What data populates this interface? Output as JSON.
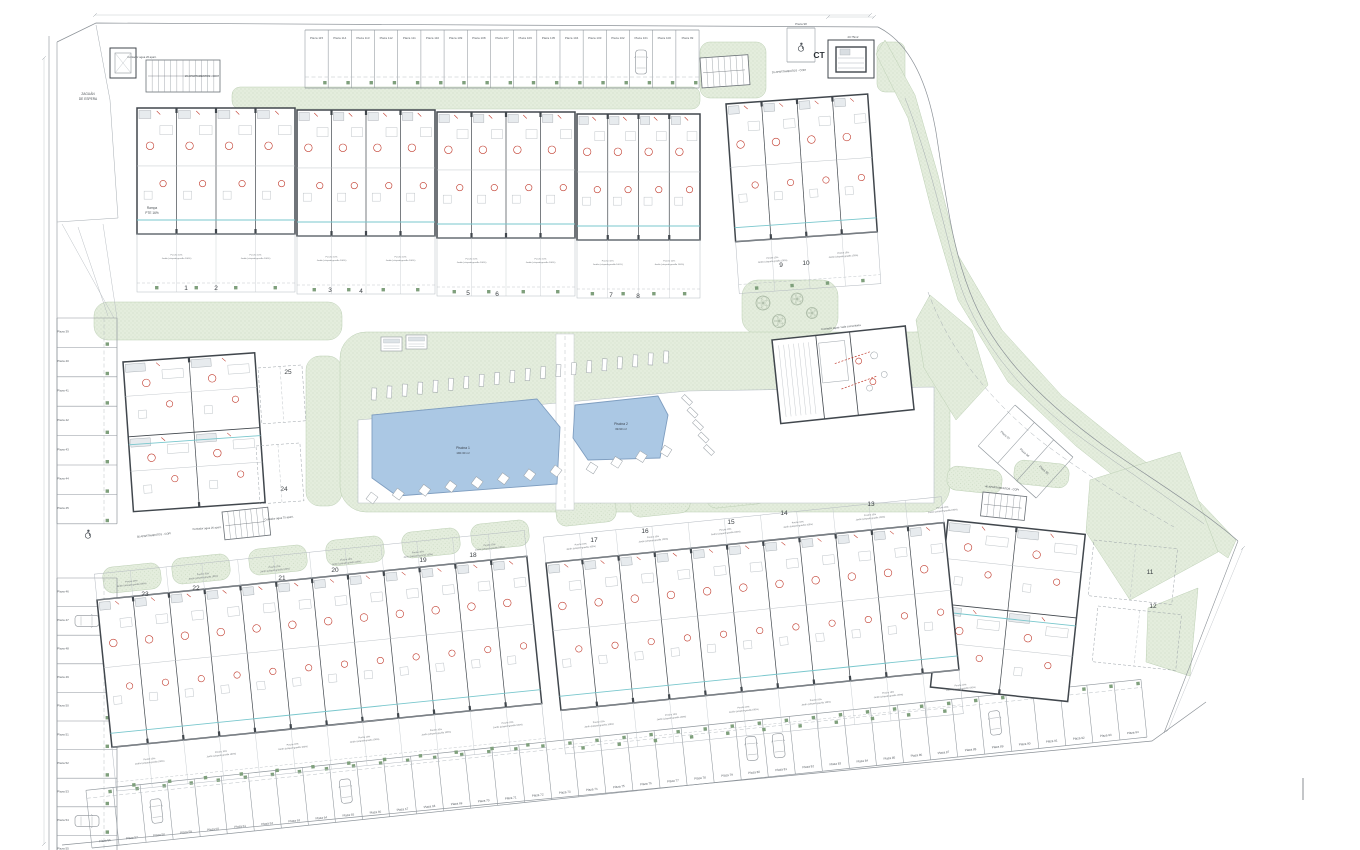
{
  "colors": {
    "paper": "#ffffff",
    "line": "#9aa1a7",
    "wall": "#41474d",
    "light": "#c0c5ca",
    "green_fill": "#e4eddd",
    "green_dot": "#c2d3b9",
    "green_stroke": "#bccfb4",
    "green_square": "#7fa07c",
    "pool_fill": "#abc8e4",
    "pool_stroke": "#7f9ec0",
    "red": "#c0392b",
    "cyan": "#79c7cd",
    "text": "#4a5055"
  },
  "annotations": {
    "zaguan_line1": "ZAGUÁN",
    "zaguan_line2": "DE ESPERA",
    "rampa_line1": "Rampa",
    "rampa_line2": "PTE 16%",
    "contador_26": "Contador agua 26 apart.",
    "contador_75": "Contador agua 75 apart.",
    "contador_comunitaria": "Contador agua / sala comunitaria",
    "apartamentos_26": "26 APARTAMENTOS - COPI",
    "apartamentos_36": "36 APARTAMENTOS - COPI",
    "apartamentos_40": "40 APARTAMENTOS - COPI",
    "ct_label": "CT",
    "ct_area": "20.75m2"
  },
  "pools": [
    {
      "name": "Piscina 1",
      "area": "190.30 m²"
    },
    {
      "name": "Piscina 2",
      "area": "39.90 m²"
    }
  ],
  "blocks": {
    "top": [
      "1",
      "2",
      "3",
      "4",
      "5",
      "6",
      "7",
      "8"
    ],
    "top_right": [
      "9",
      "10"
    ],
    "right": [
      "11",
      "12"
    ],
    "bottom_middle": [
      "13",
      "14",
      "15",
      "16",
      "17"
    ],
    "bottom_left": [
      "18",
      "19",
      "20",
      "21",
      "22",
      "23"
    ],
    "middle_left": [
      "24",
      "25"
    ]
  },
  "parking": {
    "top_row": [
      "Plaza 115",
      "Plaza 114",
      "Plaza 113",
      "Plaza 112",
      "Plaza 111",
      "Plaza 110",
      "Plaza 109",
      "Plaza 108",
      "Plaza 107",
      "Plaza 106",
      "Plaza 105",
      "Plaza 104",
      "Plaza 103",
      "Plaza 102",
      "Plaza 101",
      "Plaza 100",
      "Plaza 99"
    ],
    "ct_stall": [
      "Plaza 98"
    ],
    "left_upper": [
      "Plaza 39",
      "Plaza 40",
      "Plaza 41",
      "Plaza 42",
      "Plaza 43",
      "Plaza 44",
      "Plaza 45"
    ],
    "left_lower": [
      "Plaza 46",
      "Plaza 47",
      "Plaza 48",
      "Plaza 49",
      "Plaza 50",
      "Plaza 51",
      "Plaza 52",
      "Plaza 53",
      "Plaza 54",
      "Plaza 55"
    ],
    "bottom_row": [
      "Plaza 56",
      "Plaza 57",
      "Plaza 58",
      "Plaza 59",
      "Plaza 60",
      "Plaza 61",
      "Plaza 62",
      "Plaza 63",
      "Plaza 64",
      "Plaza 65",
      "Plaza 66",
      "Plaza 67",
      "Plaza 68",
      "Plaza 69",
      "Plaza 70",
      "Plaza 71",
      "Plaza 72",
      "Plaza 73",
      "Plaza 74",
      "Plaza 75",
      "Plaza 76",
      "Plaza 77",
      "Plaza 78",
      "Plaza 79",
      "Plaza 80",
      "Plaza 81",
      "Plaza 82",
      "Plaza 83",
      "Plaza 84",
      "Plaza 85",
      "Plaza 86",
      "Plaza 87",
      "Plaza 88",
      "Plaza 89",
      "Plaza 90",
      "Plaza 91",
      "Plaza 92",
      "Plaza 93",
      "Plaza 94"
    ],
    "diagonal": [
      "Plaza 97",
      "Plaza 96",
      "Plaza 95"
    ]
  },
  "unit_notes": [
    "Porche 10%",
    "Jardín (césped+gravilla 100%)"
  ],
  "icons": {
    "accessible": "wheelchair-icon",
    "tree": "tree-icon",
    "car": "car-icon"
  }
}
